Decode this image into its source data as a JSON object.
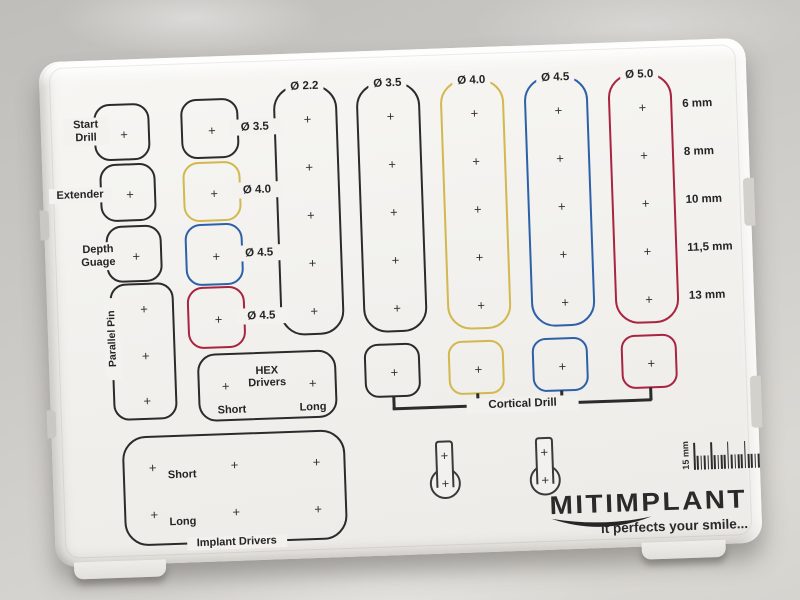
{
  "plus_mark": "+",
  "colors": {
    "print": "#2b2b2b",
    "yellow": "#d2b84e",
    "blue": "#2c61a9",
    "red": "#a8243f"
  },
  "left_tools": [
    {
      "label": "Start Drill"
    },
    {
      "label": "Extender"
    },
    {
      "label": "Depth Guage"
    },
    {
      "label": "Parallel Pin"
    }
  ],
  "sleeve_slots": [
    {
      "label": "Ø 3.5",
      "color": "print"
    },
    {
      "label": "Ø 4.0",
      "color": "yellow"
    },
    {
      "label": "Ø 4.5",
      "color": "blue"
    },
    {
      "label": "Ø 4.5",
      "color": "red"
    }
  ],
  "drill_columns": [
    {
      "label": "Ø 2.2",
      "color": "print",
      "holes": 5
    },
    {
      "label": "Ø 3.5",
      "color": "print",
      "holes": 5
    },
    {
      "label": "Ø 4.0",
      "color": "yellow",
      "holes": 5
    },
    {
      "label": "Ø 4.5",
      "color": "blue",
      "holes": 5
    },
    {
      "label": "Ø 5.0",
      "color": "red",
      "holes": 5
    }
  ],
  "depth_labels": [
    "6 mm",
    "8 mm",
    "10 mm",
    "11,5 mm",
    "13 mm"
  ],
  "hex_drivers": {
    "title_line1": "HEX",
    "title_line2": "Drivers",
    "short": "Short",
    "long": "Long"
  },
  "cortical_drill": {
    "label": "Cortical Drill",
    "slot_colors": [
      "print",
      "yellow",
      "blue",
      "red"
    ]
  },
  "implant_drivers": {
    "title": "Implant Drivers",
    "short": "Short",
    "long": "Long"
  },
  "ruler": {
    "label": "15 mm"
  },
  "brand": {
    "name": "MITIMPLANT",
    "tagline": "it perfects your smile..."
  }
}
